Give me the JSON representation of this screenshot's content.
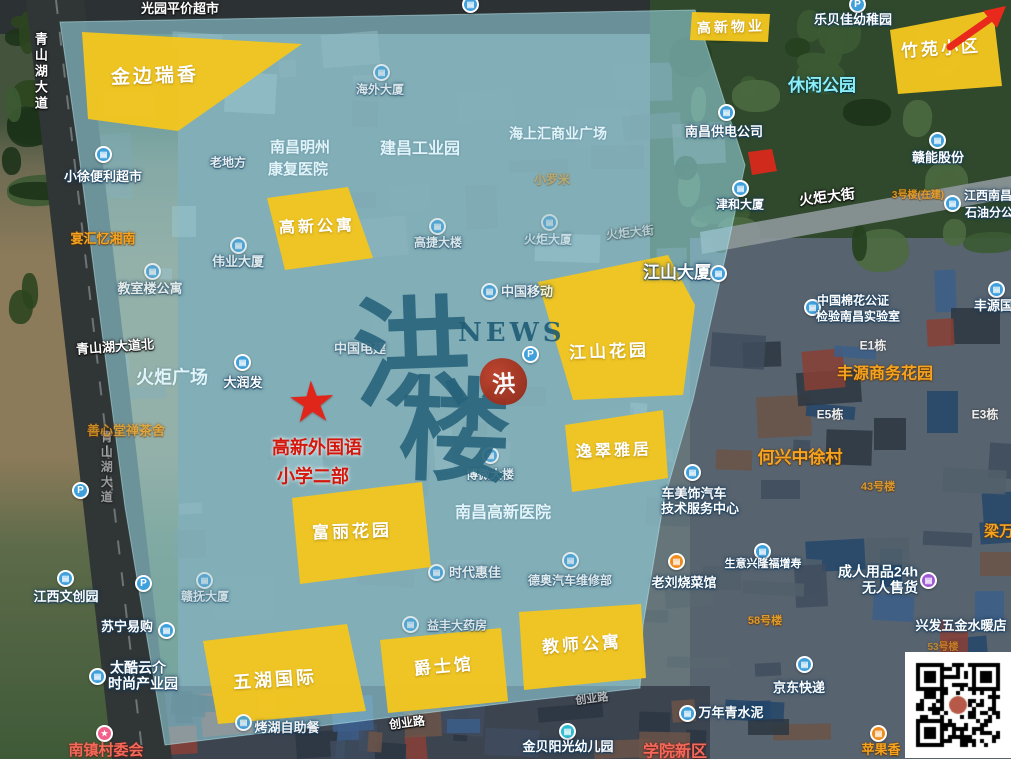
{
  "map": {
    "watermark": {
      "char_top": "洪",
      "char_bottom": "楼",
      "news": "NEWS",
      "seal": "洪"
    },
    "star_marker": {
      "glyph": "★"
    },
    "colors": {
      "highlight_region": "#f2c51f",
      "coverage_overlay": "rgba(152,216,228,0.58)",
      "marker_red": "#e0251a",
      "school_label_red": "#d4170c",
      "orange_label": "#f6a41f",
      "watermark_teal": "#26627a"
    },
    "coverage_points": "60,22 695,10 745,165 727,250 693,400 664,500 643,625 640,688 515,702 385,718 165,745 125,507 100,317 77,140"
  },
  "regions": [
    {
      "label": "金边瑞香",
      "points": "82,32 302,44 178,131 88,119",
      "lx": 155,
      "ly": 77,
      "fs": 19,
      "rot": -2
    },
    {
      "label": "高新物业",
      "points": "692,12 770,14 768,42 690,40",
      "lx": 731,
      "ly": 27,
      "fs": 14,
      "rot": -2
    },
    {
      "label": "竹苑小区",
      "points": "890,30 993,10 1002,86 898,94",
      "lx": 941,
      "ly": 49,
      "fs": 17,
      "rot": -4
    },
    {
      "label": "高新公寓",
      "points": "267,198 348,187 373,258 285,270",
      "lx": 317,
      "ly": 228,
      "fs": 16,
      "rot": -2
    },
    {
      "label": "江山花园",
      "points": "538,282 668,255 695,305 683,395 573,400",
      "lx": 609,
      "ly": 352,
      "fs": 17,
      "rot": -2
    },
    {
      "label": "逸翠雅居",
      "points": "565,425 663,410 668,478 572,492",
      "lx": 614,
      "ly": 452,
      "fs": 16,
      "rot": -2
    },
    {
      "label": "富丽花园",
      "points": "292,498 422,482 431,567 300,584",
      "lx": 352,
      "ly": 532,
      "fs": 17,
      "rot": -2
    },
    {
      "label": "五湖国际",
      "points": "203,641 347,624 366,711 218,724",
      "lx": 275,
      "ly": 680,
      "fs": 18,
      "rot": -4
    },
    {
      "label": "爵士馆",
      "points": "380,640 501,628 508,701 388,713",
      "lx": 444,
      "ly": 667,
      "fs": 17,
      "rot": -5
    },
    {
      "label": "教师公寓",
      "points": "519,612 641,604 646,678 524,690",
      "lx": 582,
      "ly": 645,
      "fs": 17,
      "rot": -4
    }
  ],
  "labels": [
    {
      "t": "光园平价超市",
      "x": 180,
      "y": 9,
      "k": "road",
      "s": 13
    },
    {
      "t": "青山湖大道",
      "x": 40,
      "y": 72,
      "k": "road",
      "s": 13,
      "v": 1
    },
    {
      "t": "青山湖大道",
      "x": 106,
      "y": 468,
      "k": "road",
      "s": 12,
      "v": 1,
      "o": 0.5
    },
    {
      "t": "青山湖大道北",
      "x": 115,
      "y": 347,
      "k": "road",
      "s": 13,
      "r": -4
    },
    {
      "t": "火炬大街",
      "x": 827,
      "y": 197,
      "k": "road",
      "s": 14,
      "r": -7
    },
    {
      "t": "火炬大街",
      "x": 630,
      "y": 233,
      "k": "road",
      "s": 12,
      "r": -6,
      "o": 0.4
    },
    {
      "t": "创业路",
      "x": 407,
      "y": 723,
      "k": "road",
      "s": 12,
      "r": -7
    },
    {
      "t": "创业路",
      "x": 592,
      "y": 700,
      "k": "road",
      "s": 11,
      "r": -7,
      "o": 0.6
    },
    {
      "t": "小徐便利超市",
      "x": 103,
      "y": 177,
      "k": "poi",
      "s": 13
    },
    {
      "t": "老地方",
      "x": 228,
      "y": 163,
      "k": "poi",
      "s": 12,
      "o": 0.8
    },
    {
      "t": "宴汇忆湘南",
      "x": 103,
      "y": 239,
      "k": "orange",
      "s": 13
    },
    {
      "t": "教室楼公寓",
      "x": 150,
      "y": 289,
      "k": "poi",
      "s": 13,
      "o": 0.75
    },
    {
      "t": "伟业大厦",
      "x": 238,
      "y": 262,
      "k": "poi",
      "s": 13,
      "o": 0.75
    },
    {
      "t": "南昌明州",
      "x": 300,
      "y": 148,
      "k": "bluefaint",
      "s": 15
    },
    {
      "t": "康复医院",
      "x": 298,
      "y": 170,
      "k": "bluefaint",
      "s": 15
    },
    {
      "t": "建昌工业园",
      "x": 420,
      "y": 150,
      "k": "bluefaint",
      "s": 16
    },
    {
      "t": "海上汇商业广场",
      "x": 558,
      "y": 134,
      "k": "bluefaint",
      "s": 14
    },
    {
      "t": "海外大厦",
      "x": 380,
      "y": 90,
      "k": "poi",
      "s": 12,
      "o": 0.7
    },
    {
      "t": "乐贝佳幼稚园",
      "x": 853,
      "y": 20,
      "k": "poi",
      "s": 13
    },
    {
      "t": "休闲公园",
      "x": 822,
      "y": 86,
      "k": "cyanlbl",
      "s": 17
    },
    {
      "t": "南昌供电公司",
      "x": 724,
      "y": 132,
      "k": "poi",
      "s": 13
    },
    {
      "t": "赣能股份",
      "x": 938,
      "y": 158,
      "k": "poi",
      "s": 13
    },
    {
      "t": "津和大厦",
      "x": 740,
      "y": 205,
      "k": "poi",
      "s": 12
    },
    {
      "t": "3号楼(在建)",
      "x": 918,
      "y": 196,
      "k": "orange",
      "s": 10,
      "o": 0.85
    },
    {
      "t": "江西南昌",
      "x": 988,
      "y": 196,
      "k": "poi",
      "s": 12
    },
    {
      "t": "石油分公司",
      "x": 995,
      "y": 213,
      "k": "poi",
      "s": 12
    },
    {
      "t": "火炬大厦",
      "x": 548,
      "y": 240,
      "k": "poi",
      "s": 12,
      "o": 0.5
    },
    {
      "t": "小罗米",
      "x": 552,
      "y": 180,
      "k": "orange",
      "s": 12,
      "o": 0.45
    },
    {
      "t": "高捷大楼",
      "x": 438,
      "y": 243,
      "k": "poi",
      "s": 12,
      "o": 0.7
    },
    {
      "t": "中国移动",
      "x": 527,
      "y": 292,
      "k": "poi",
      "s": 13,
      "o": 0.8
    },
    {
      "t": "中国电建",
      "x": 360,
      "y": 349,
      "k": "poi",
      "s": 13,
      "o": 0.7
    },
    {
      "t": "江山大厦",
      "x": 677,
      "y": 273,
      "k": "poi",
      "s": 17
    },
    {
      "t": "中国棉花公证",
      "x": 853,
      "y": 301,
      "k": "poi",
      "s": 12
    },
    {
      "t": "检验南昌实验室",
      "x": 858,
      "y": 317,
      "k": "poi",
      "s": 12
    },
    {
      "t": "丰源国际",
      "x": 1000,
      "y": 306,
      "k": "poi",
      "s": 13
    },
    {
      "t": "E1栋",
      "x": 873,
      "y": 346,
      "k": "darkf",
      "s": 12
    },
    {
      "t": "丰源商务花园",
      "x": 885,
      "y": 375,
      "k": "orange",
      "s": 16
    },
    {
      "t": "E5栋",
      "x": 830,
      "y": 415,
      "k": "darkf",
      "s": 12
    },
    {
      "t": "E3栋",
      "x": 985,
      "y": 415,
      "k": "darkf",
      "s": 12
    },
    {
      "t": "火炬广场",
      "x": 172,
      "y": 378,
      "k": "bluefaint",
      "s": 18
    },
    {
      "t": "大润发",
      "x": 243,
      "y": 383,
      "k": "poi",
      "s": 13
    },
    {
      "t": "善心堂禅茶舍",
      "x": 126,
      "y": 431,
      "k": "orange",
      "s": 13,
      "o": 0.75
    },
    {
      "t": "高新外国语",
      "x": 317,
      "y": 448,
      "k": "redtext",
      "s": 18
    },
    {
      "t": "小学二部",
      "x": 313,
      "y": 477,
      "k": "redtext",
      "s": 18
    },
    {
      "t": "何兴中徐村",
      "x": 800,
      "y": 458,
      "k": "orange",
      "s": 17
    },
    {
      "t": "43号楼",
      "x": 878,
      "y": 488,
      "k": "orange",
      "s": 11,
      "o": 0.8
    },
    {
      "t": "梁万",
      "x": 999,
      "y": 532,
      "k": "orange",
      "s": 15
    },
    {
      "t": "车美饰汽车",
      "x": 694,
      "y": 494,
      "k": "poi",
      "s": 13
    },
    {
      "t": "技术服务中心",
      "x": 700,
      "y": 509,
      "k": "poi",
      "s": 13
    },
    {
      "t": "博微大楼",
      "x": 490,
      "y": 475,
      "k": "poi",
      "s": 12,
      "o": 0.75
    },
    {
      "t": "南昌高新医院",
      "x": 503,
      "y": 514,
      "k": "bluefaint",
      "s": 16
    },
    {
      "t": "时代惠佳",
      "x": 475,
      "y": 573,
      "k": "poi",
      "s": 13,
      "o": 0.75
    },
    {
      "t": "德奥汽车维修部",
      "x": 570,
      "y": 581,
      "k": "poi",
      "s": 12,
      "o": 0.75
    },
    {
      "t": "老刘烧菜馆",
      "x": 684,
      "y": 583,
      "k": "poi",
      "s": 13
    },
    {
      "t": "生意兴隆福增寿",
      "x": 763,
      "y": 565,
      "k": "poi",
      "s": 11
    },
    {
      "t": "成人用品24h",
      "x": 878,
      "y": 572,
      "k": "poi",
      "s": 14
    },
    {
      "t": "无人售货",
      "x": 890,
      "y": 588,
      "k": "poi",
      "s": 14
    },
    {
      "t": "兴发五金水暖店",
      "x": 961,
      "y": 626,
      "k": "poi",
      "s": 13
    },
    {
      "t": "53号楼",
      "x": 943,
      "y": 648,
      "k": "orange",
      "s": 10,
      "o": 0.6
    },
    {
      "t": "江西文创园",
      "x": 66,
      "y": 597,
      "k": "poi",
      "s": 13
    },
    {
      "t": "赣抚大厦",
      "x": 205,
      "y": 597,
      "k": "poi",
      "s": 12,
      "o": 0.6
    },
    {
      "t": "苏宁易购",
      "x": 127,
      "y": 627,
      "k": "poi",
      "s": 13
    },
    {
      "t": "太酷云介",
      "x": 138,
      "y": 668,
      "k": "poi",
      "s": 14
    },
    {
      "t": "时尚产业园",
      "x": 143,
      "y": 684,
      "k": "poi",
      "s": 14
    },
    {
      "t": "益丰大药房",
      "x": 457,
      "y": 626,
      "k": "poi",
      "s": 12,
      "o": 0.7
    },
    {
      "t": "烤湖自助餐",
      "x": 287,
      "y": 728,
      "k": "poi",
      "s": 13,
      "o": 0.9
    },
    {
      "t": "58号楼",
      "x": 765,
      "y": 622,
      "k": "orange",
      "s": 11,
      "o": 0.85
    },
    {
      "t": "南镇村委会",
      "x": 106,
      "y": 751,
      "k": "redorange",
      "s": 15
    },
    {
      "t": "金贝阳光幼儿园",
      "x": 568,
      "y": 747,
      "k": "poi",
      "s": 13
    },
    {
      "t": "学院新区",
      "x": 675,
      "y": 753,
      "k": "redorange",
      "s": 16
    },
    {
      "t": "万年青水泥",
      "x": 731,
      "y": 713,
      "k": "poi",
      "s": 13
    },
    {
      "t": "京东快递",
      "x": 799,
      "y": 688,
      "k": "poi",
      "s": 13
    },
    {
      "t": "苹果香",
      "x": 881,
      "y": 750,
      "k": "orange",
      "s": 13
    }
  ],
  "pois": [
    {
      "x": 103,
      "y": 154
    },
    {
      "x": 381,
      "y": 72,
      "o": 0.7
    },
    {
      "x": 470,
      "y": 4
    },
    {
      "x": 857,
      "y": 4,
      "t": "p"
    },
    {
      "x": 152,
      "y": 271,
      "o": 0.75
    },
    {
      "x": 238,
      "y": 245,
      "o": 0.75
    },
    {
      "x": 437,
      "y": 226,
      "o": 0.7
    },
    {
      "x": 489,
      "y": 291,
      "o": 0.8
    },
    {
      "x": 549,
      "y": 222,
      "o": 0.5
    },
    {
      "x": 242,
      "y": 362
    },
    {
      "x": 80,
      "y": 490,
      "t": "p"
    },
    {
      "x": 530,
      "y": 354,
      "t": "p"
    },
    {
      "x": 726,
      "y": 112
    },
    {
      "x": 937,
      "y": 140
    },
    {
      "x": 740,
      "y": 188
    },
    {
      "x": 952,
      "y": 203
    },
    {
      "x": 996,
      "y": 289
    },
    {
      "x": 812,
      "y": 307
    },
    {
      "x": 718,
      "y": 273
    },
    {
      "x": 692,
      "y": 472,
      "t": "car"
    },
    {
      "x": 676,
      "y": 561,
      "t": "food"
    },
    {
      "x": 762,
      "y": 551
    },
    {
      "x": 928,
      "y": 580,
      "t": "bag"
    },
    {
      "x": 804,
      "y": 664,
      "t": "truck"
    },
    {
      "x": 687,
      "y": 713
    },
    {
      "x": 567,
      "y": 731,
      "t": "kid"
    },
    {
      "x": 878,
      "y": 733,
      "t": "food"
    },
    {
      "x": 490,
      "y": 455,
      "o": 0.75
    },
    {
      "x": 436,
      "y": 572,
      "o": 0.75
    },
    {
      "x": 570,
      "y": 560,
      "o": 0.75
    },
    {
      "x": 410,
      "y": 624,
      "o": 0.7
    },
    {
      "x": 243,
      "y": 722,
      "o": 0.9
    },
    {
      "x": 104,
      "y": 733,
      "t": "star"
    },
    {
      "x": 65,
      "y": 578
    },
    {
      "x": 204,
      "y": 580,
      "o": 0.6
    },
    {
      "x": 143,
      "y": 583,
      "t": "p"
    },
    {
      "x": 166,
      "y": 630
    },
    {
      "x": 97,
      "y": 676
    }
  ]
}
